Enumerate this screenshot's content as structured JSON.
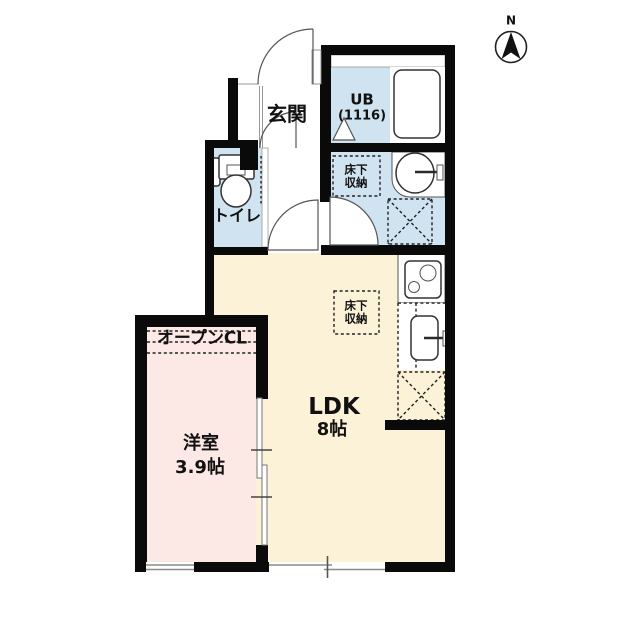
{
  "compass": {
    "label": "N"
  },
  "labels": {
    "genkan": "玄関",
    "ub": "UB",
    "ub_size": "(1116)",
    "toilet": "トイレ",
    "storage_wash_l1": "床下",
    "storage_wash_l2": "収納",
    "storage_ldk_l1": "床下",
    "storage_ldk_l2": "収納",
    "ldk": "LDK",
    "ldk_size": "8帖",
    "western": "洋室",
    "western_size": "3.9帖",
    "open_closet": "オープンCL"
  },
  "colors": {
    "wall": "#0a0a0a",
    "water": "#cfe3f1",
    "ldk_floor": "#fcf2d8",
    "room_floor": "#fce9e5",
    "window_line": "#8a8a8a",
    "outline": "#333333"
  }
}
